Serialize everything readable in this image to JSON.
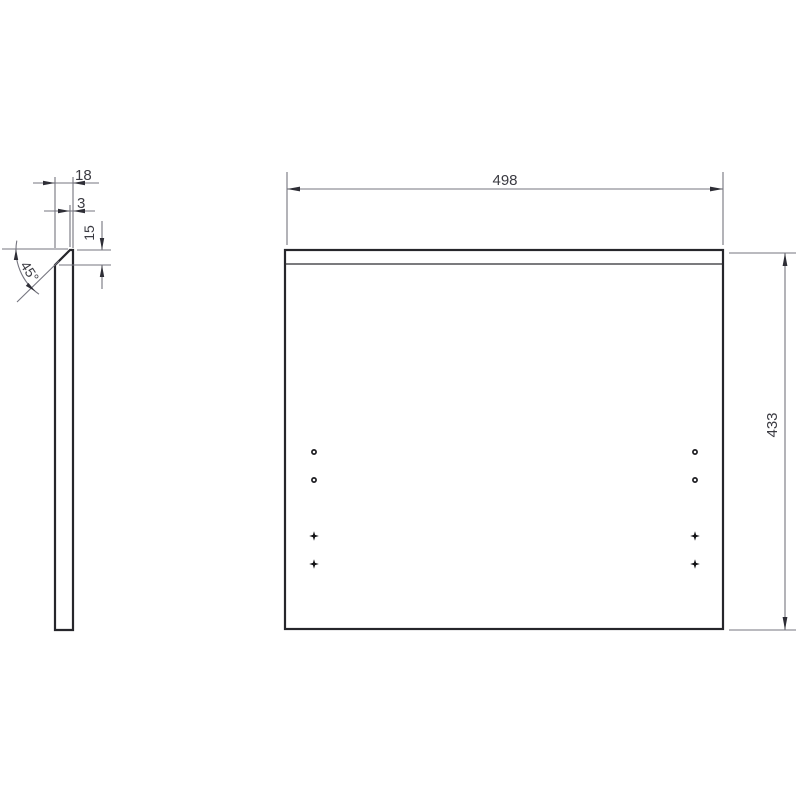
{
  "drawing": {
    "type": "technical-drawing",
    "background": "#ffffff",
    "colors": {
      "part_outline": "#26262b",
      "dimension_lines": "#75757f",
      "dimension_text": "#3b3b42",
      "marks": "#111114"
    },
    "views": {
      "side_view": {
        "description": "side profile of panel with 45-degree top chamfer",
        "thickness_label": "18",
        "top_face_label": "3",
        "chamfer_height_label": "15",
        "chamfer_angle_label": "45°"
      },
      "front_view": {
        "description": "front face of panel with top edge line and fastener marks",
        "width_label": "498",
        "height_label": "433"
      }
    },
    "dimensions": {
      "thickness": {
        "label": "18"
      },
      "top_face": {
        "label": "3"
      },
      "chamfer_height": {
        "label": "15"
      },
      "chamfer_angle": {
        "label": "45°"
      },
      "width": {
        "label": "498"
      },
      "height": {
        "label": "433"
      }
    },
    "marks": {
      "hole_points": [
        {
          "x": 314,
          "y": 452
        },
        {
          "x": 314,
          "y": 480
        },
        {
          "x": 695,
          "y": 452
        },
        {
          "x": 695,
          "y": 480
        }
      ],
      "center_marks": [
        {
          "x": 314,
          "y": 536
        },
        {
          "x": 314,
          "y": 564
        },
        {
          "x": 695,
          "y": 536
        },
        {
          "x": 695,
          "y": 564
        }
      ]
    }
  }
}
